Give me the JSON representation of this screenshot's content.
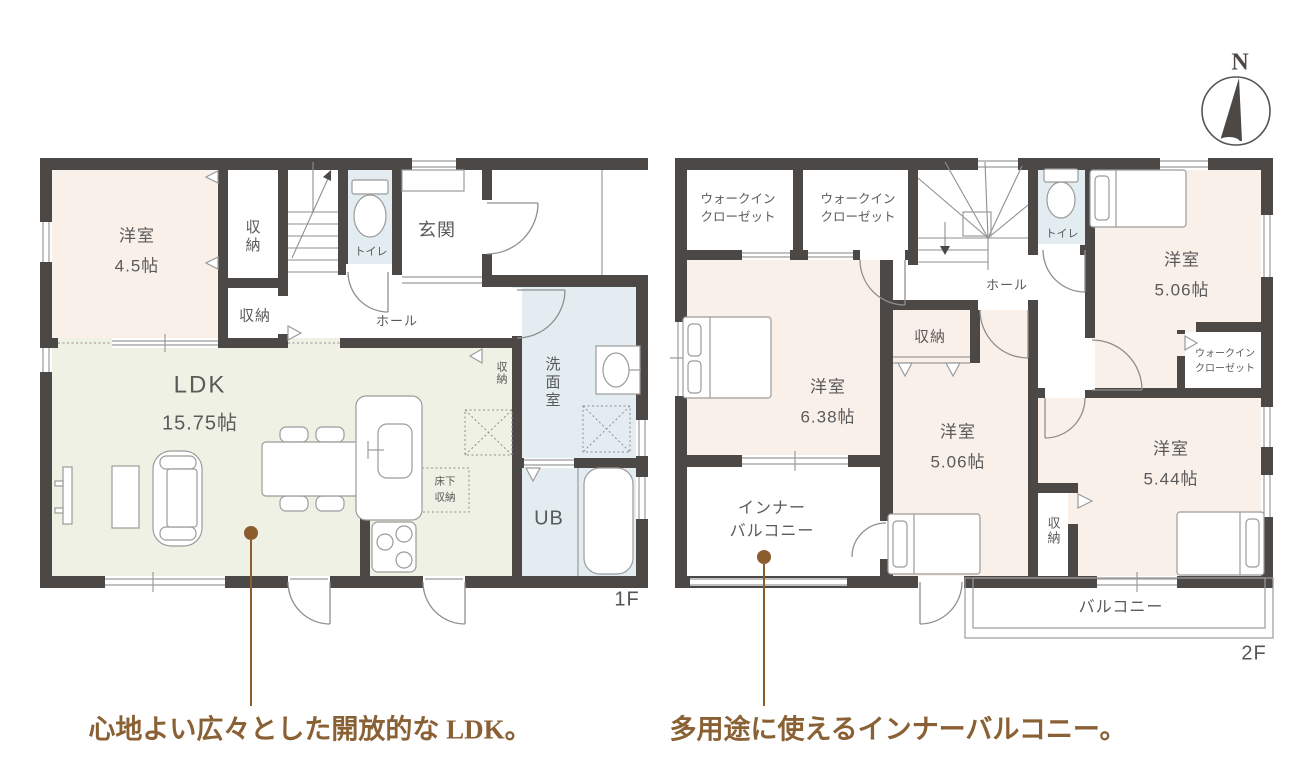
{
  "compass": {
    "label": "N"
  },
  "f1": {
    "label": "1F",
    "youshitsu": {
      "name": "洋室",
      "size": "4.5帖"
    },
    "closet_u": "収納",
    "closet_l": "収納",
    "closet_s": "収納",
    "toilet": "トイレ",
    "genkan": "玄関",
    "hall": "ホール",
    "ldk": {
      "name": "LDK",
      "size": "15.75帖"
    },
    "senmen": "洗面室",
    "yukashita": "床下収納",
    "ub": "UB"
  },
  "f2": {
    "label": "2F",
    "wic1": {
      "l1": "ウォークイン",
      "l2": "クローゼット"
    },
    "wic2": {
      "l1": "ウォークイン",
      "l2": "クローゼット"
    },
    "wic3": {
      "l1": "ウォークイン",
      "l2": "クローゼット"
    },
    "toilet": "トイレ",
    "hall": "ホール",
    "closet_c": "収納",
    "closet_r": "収納",
    "y_tr": {
      "name": "洋室",
      "size": "5.06帖"
    },
    "y_l": {
      "name": "洋室",
      "size": "6.38帖"
    },
    "y_c": {
      "name": "洋室",
      "size": "5.06帖"
    },
    "y_br": {
      "name": "洋室",
      "size": "5.44帖"
    },
    "inner_balcony": {
      "l1": "インナー",
      "l2": "バルコニー"
    },
    "balcony": "バルコニー"
  },
  "captions": {
    "ldk": "心地よい広々とした開放的な LDK。",
    "balcony": "多用途に使えるインナーバルコニー。"
  },
  "colors": {
    "wall": "#4b4846",
    "room_pink": "#faf0ea",
    "room_green": "#f0f1e5",
    "room_blue": "#e2ecf1",
    "caption_brown": "#8a6134",
    "leader_brown": "#8a5c2e"
  }
}
